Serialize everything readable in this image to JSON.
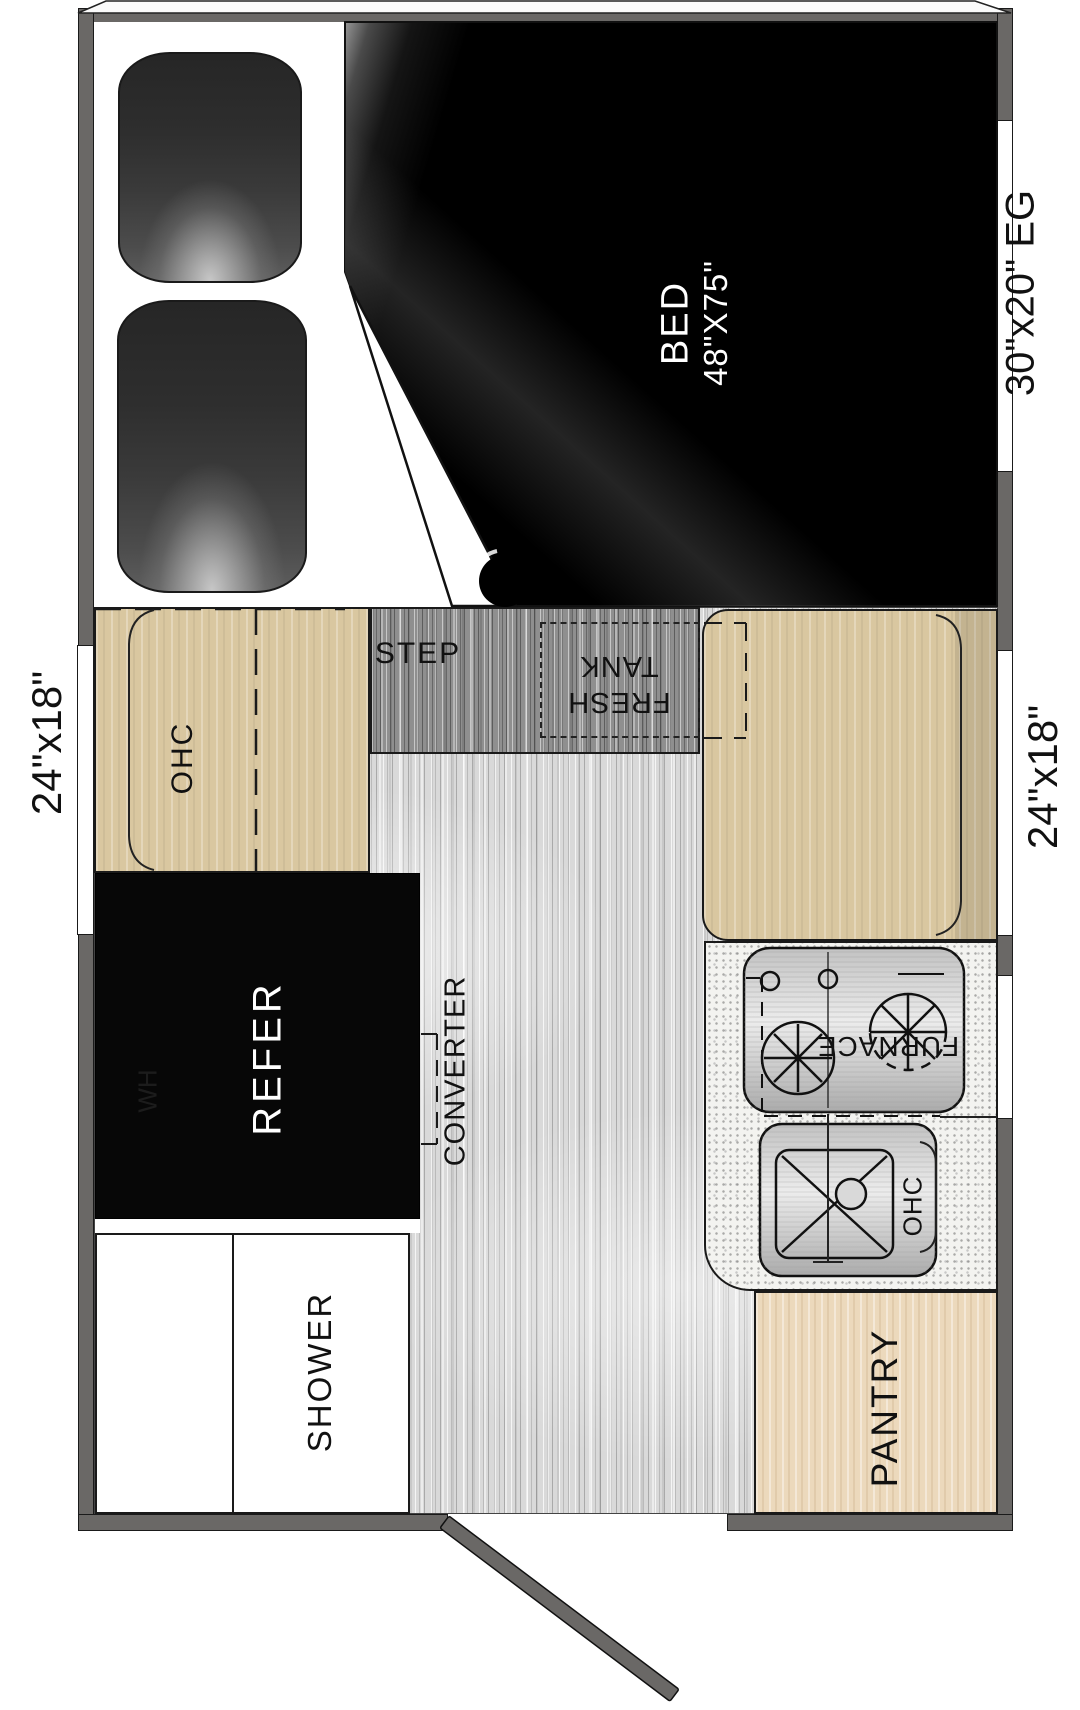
{
  "plan": {
    "type": "truck-camper floor plan",
    "bed": {
      "label": "BED",
      "size": "48\"X75\""
    },
    "step_label": "STEP",
    "fresh_tank": {
      "line1": "FRESH",
      "line2": "TANK"
    },
    "ohc_left_label": "OHC",
    "refer_label": "REFER",
    "water_heater_label": "WH",
    "converter_label": "CONVERTER",
    "shower_label": "SHOWER",
    "furnace_label": "FURNACE",
    "ohc_kitchen_label": "OHC",
    "pantry_label": "PANTRY"
  },
  "windows": {
    "left_dimension": "24\"x18\"",
    "right_dimension": "24\"x18\"",
    "right_front_dimension": "30\"x20\" EG"
  },
  "colors": {
    "wall": "#6a6866",
    "bed_dark": "#000000",
    "cabinet_tan": "#d9c7a0",
    "pantry_tan": "#ecd9bc",
    "floor_gray": "#d9d9d9",
    "step_gray": "#8f8f8f",
    "label_ink": "#111111"
  }
}
